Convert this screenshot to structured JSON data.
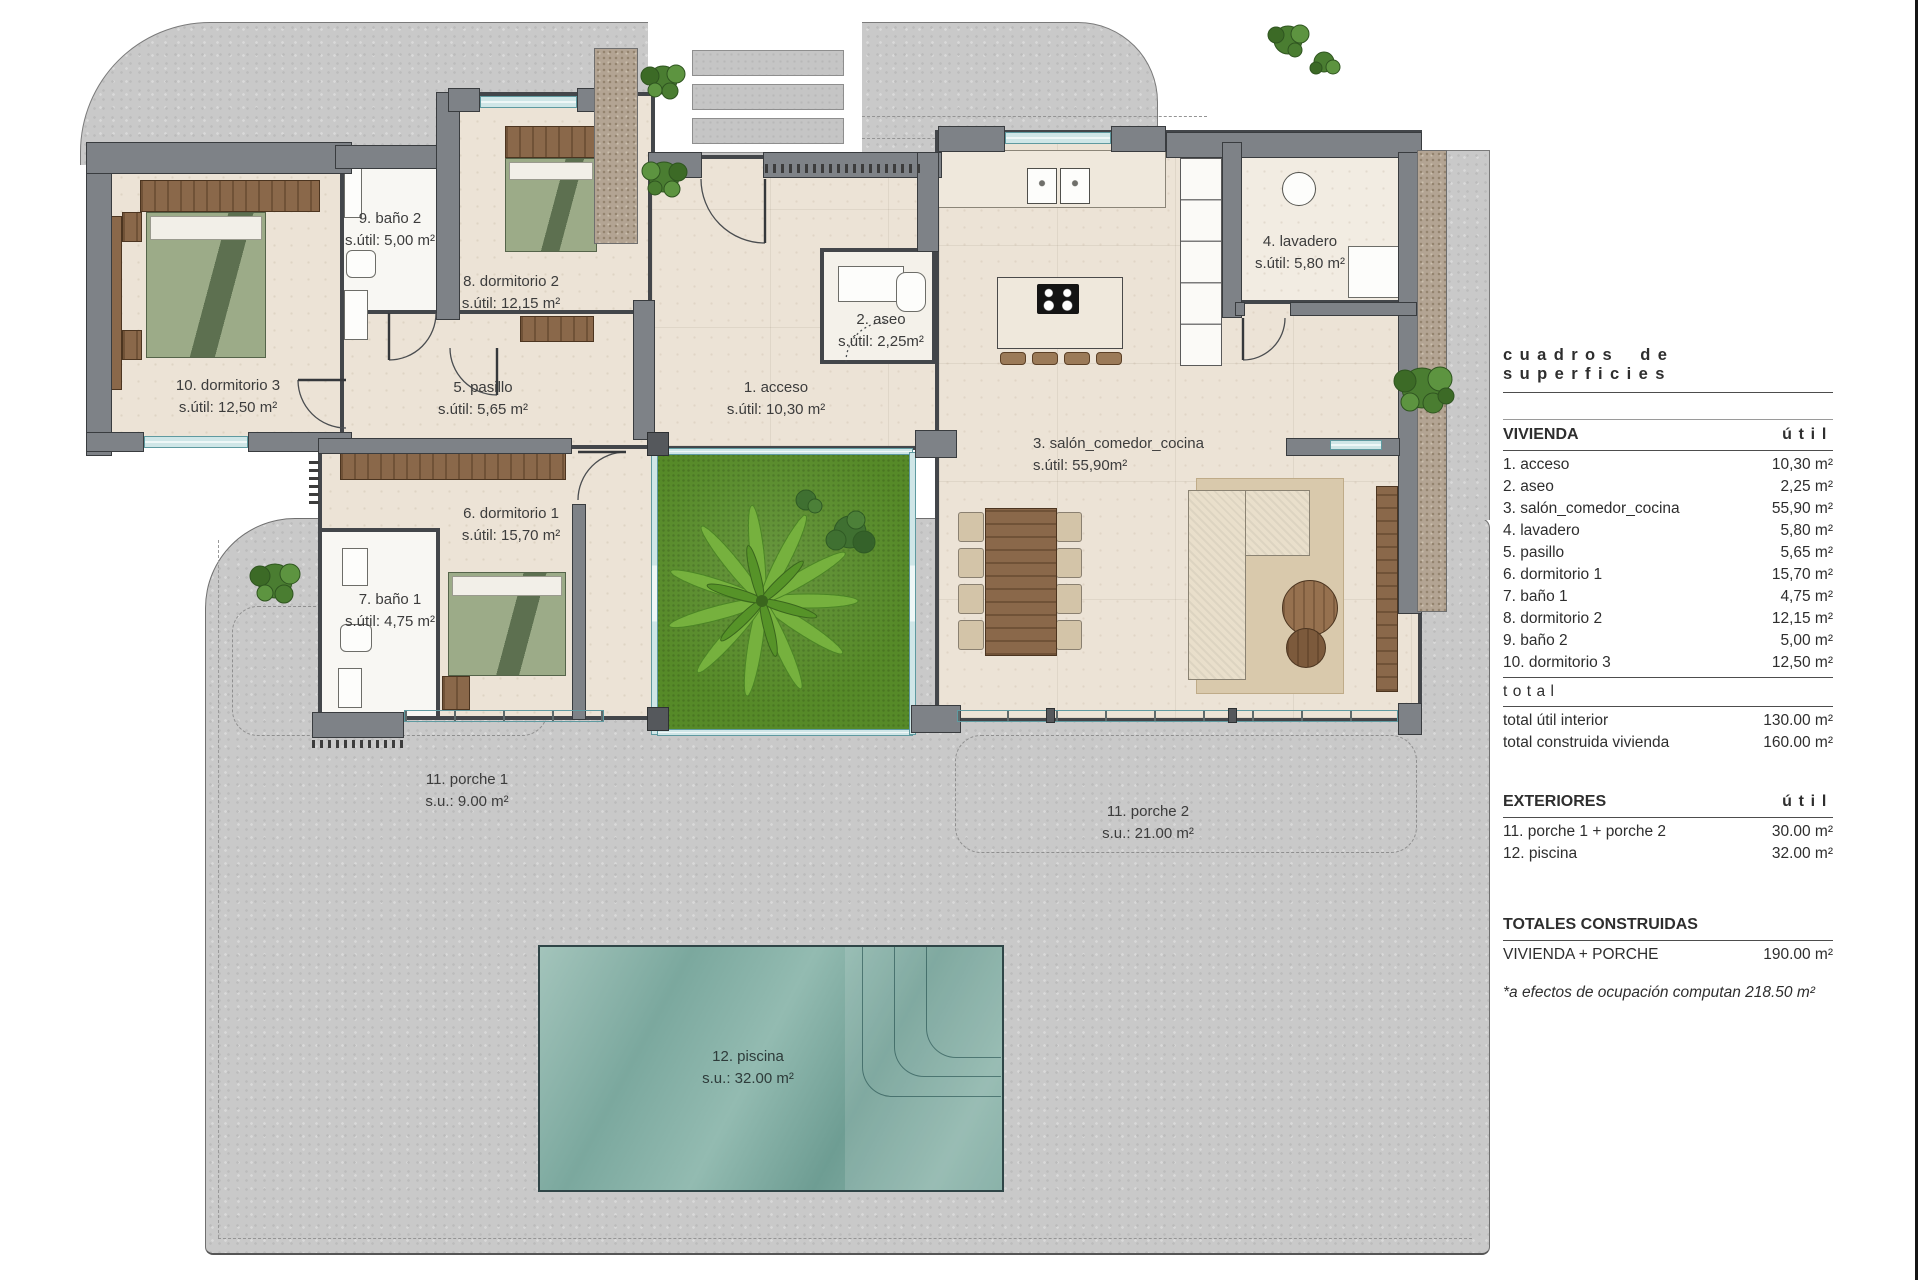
{
  "panel": {
    "title": "cuadros de superficies",
    "vivienda": {
      "header": "VIVIENDA",
      "util_header": "útil",
      "rows": [
        {
          "label": "1. acceso",
          "value": "10,30 m²"
        },
        {
          "label": "2. aseo",
          "value": "2,25 m²"
        },
        {
          "label": "3. salón_comedor_cocina",
          "value": "55,90 m²"
        },
        {
          "label": "4. lavadero",
          "value": "5,80 m²"
        },
        {
          "label": "5. pasillo",
          "value": "5,65 m²"
        },
        {
          "label": "6. dormitorio 1",
          "value": "15,70 m²"
        },
        {
          "label": "7. baño 1",
          "value": "4,75 m²"
        },
        {
          "label": "8. dormitorio 2",
          "value": "12,15 m²"
        },
        {
          "label": "9. baño 2",
          "value": "5,00 m²"
        },
        {
          "label": "10. dormitorio 3",
          "value": "12,50 m²"
        }
      ]
    },
    "total": {
      "header": "total",
      "rows": [
        {
          "label": "total útil interior",
          "value": "130.00 m²"
        },
        {
          "label": "total construida vivienda",
          "value": "160.00 m²"
        }
      ]
    },
    "exteriores": {
      "header": "EXTERIORES",
      "util_header": "útil",
      "rows": [
        {
          "label": "11. porche 1 + porche 2",
          "value": "30.00 m²"
        },
        {
          "label": "12. piscina",
          "value": "32.00 m²"
        }
      ]
    },
    "totales": {
      "header": "TOTALES CONSTRUIDAS",
      "rows": [
        {
          "label": "VIVIENDA + PORCHE",
          "value": "190.00 m²"
        }
      ]
    },
    "footnote": "*a efectos de ocupación computan 218.50 m²"
  },
  "plan": {
    "rooms": [
      {
        "name": "1. acceso",
        "area": "s.útil: 10,30 m²"
      },
      {
        "name": "2. aseo",
        "area": "s.útil: 2,25m²"
      },
      {
        "name": "3. salón_comedor_cocina",
        "area": "s.útil: 55,90m²"
      },
      {
        "name": "4. lavadero",
        "area": "s.útil: 5,80 m²"
      },
      {
        "name": "5. pasillo",
        "area": "s.útil: 5,65 m²"
      },
      {
        "name": "6. dormitorio 1",
        "area": "s.útil: 15,70 m²"
      },
      {
        "name": "7. baño 1",
        "area": "s.útil: 4,75 m²"
      },
      {
        "name": "8. dormitorio 2",
        "area": "s.útil: 12,15 m²"
      },
      {
        "name": "9. baño 2",
        "area": "s.útil: 5,00 m²"
      },
      {
        "name": "10. dormitorio 3",
        "area": "s.útil: 12,50 m²"
      },
      {
        "name": "11. porche 1",
        "area": "s.u.: 9.00 m²"
      },
      {
        "name": "11. porche 2",
        "area": "s.u.: 21.00 m²"
      },
      {
        "name": "12. piscina",
        "area": "s.u.: 32.00 m²"
      }
    ]
  },
  "colors": {
    "wall": "#7e8287",
    "floor": "#ece3d6",
    "grass": "#568a28",
    "pool_water": "#7ba89e",
    "wood": "#8a684a",
    "paving": "#c9c9c9",
    "glass": "#cfe6e7"
  }
}
